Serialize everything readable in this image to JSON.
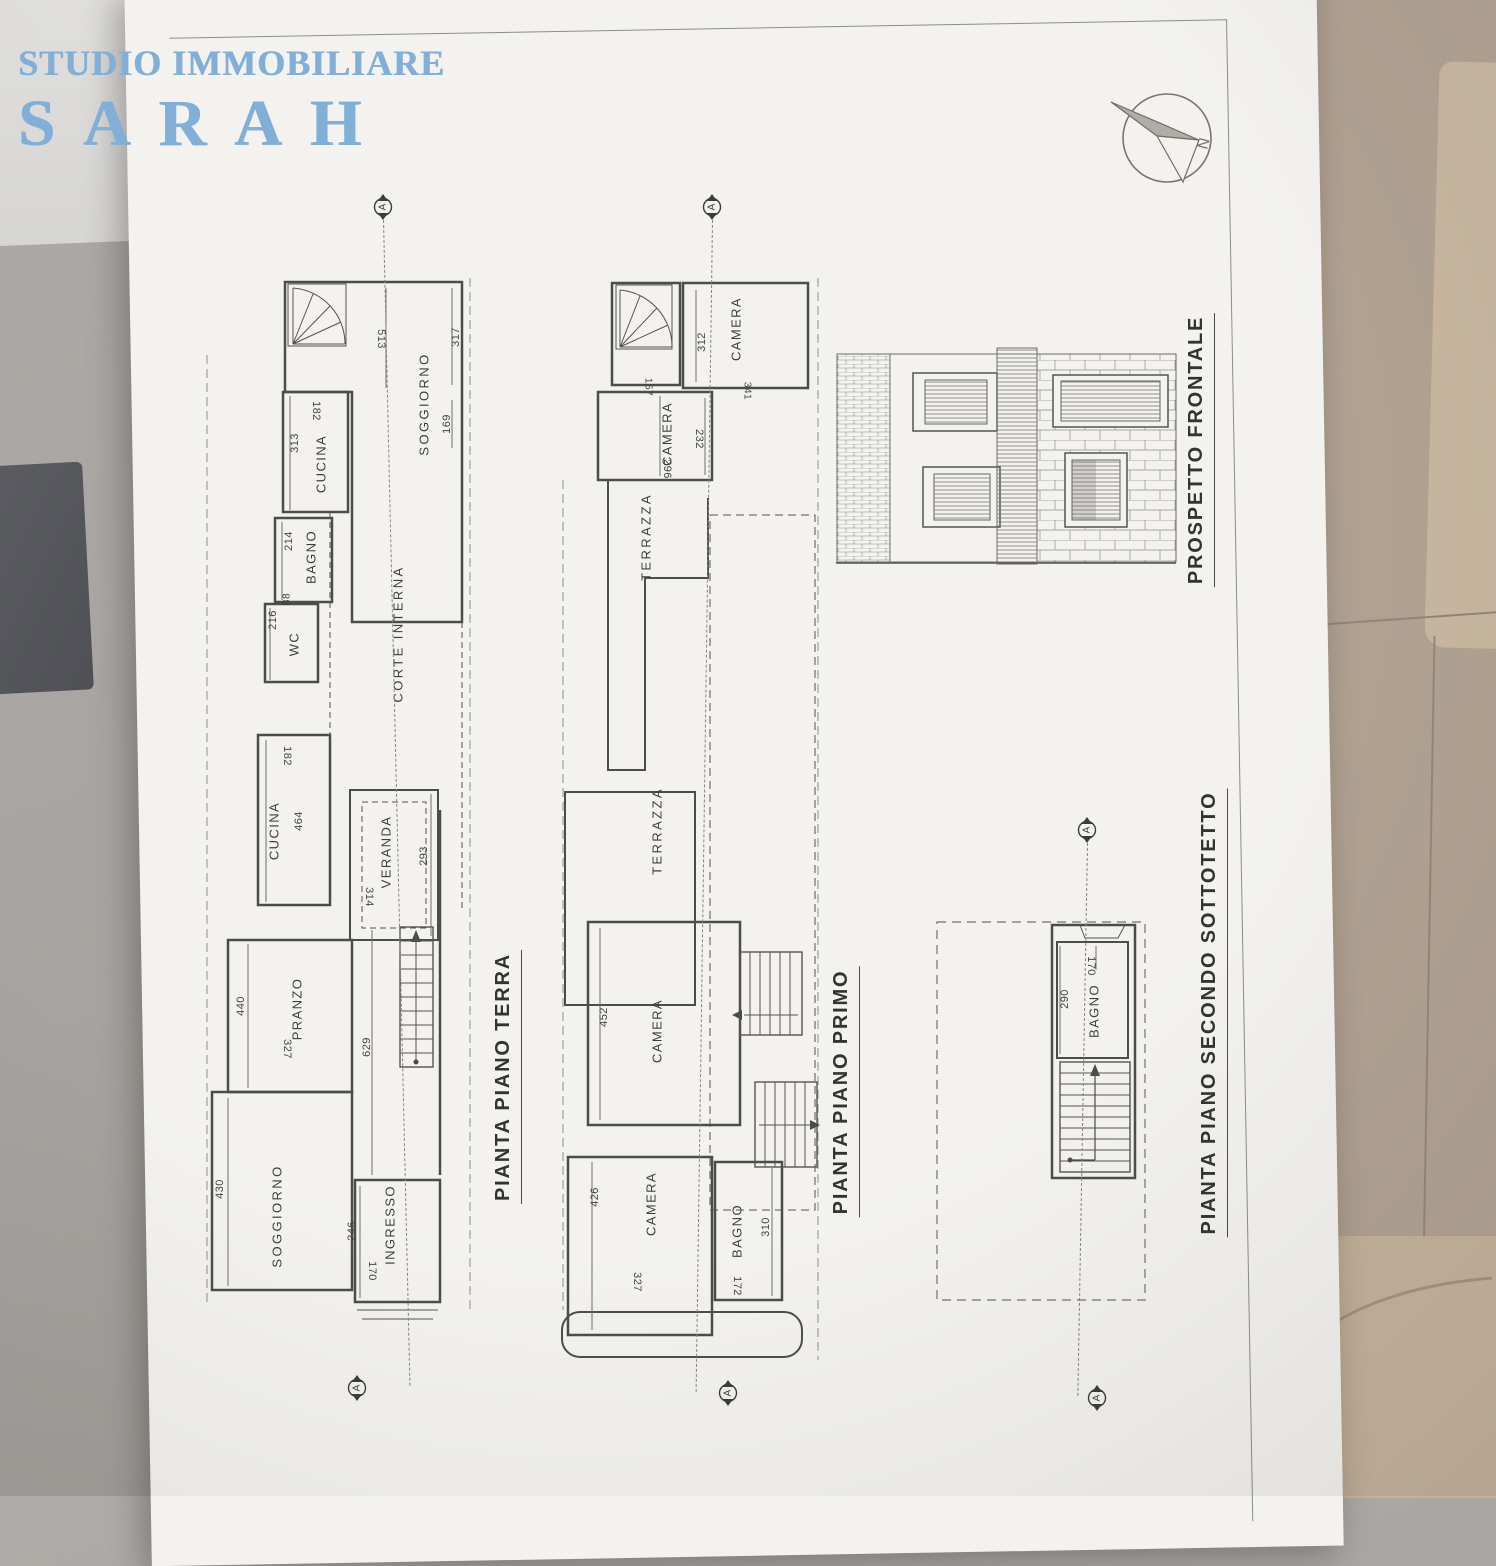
{
  "watermark": {
    "line1": "STUDIO IMMOBILIARE",
    "line2": "SARAH",
    "blue": "#82afd8"
  },
  "compass": {
    "label": "N"
  },
  "section": {
    "label": "A"
  },
  "colors": {
    "paper": "#f3f2ef",
    "ink": "#4c4c48",
    "table": "#a8a4a1",
    "floor": "#b1a292",
    "chair": "#c9b7a0"
  },
  "plans": {
    "terra": {
      "title": "PIANTA PIANO TERRA",
      "rooms": {
        "soggiorno_n": "SOGGIORNO",
        "cucina_n": "CUCINA",
        "bagno": "BAGNO",
        "wc": "WC",
        "corte": "CORTE INTERNA",
        "cucina_s": "CUCINA",
        "veranda": "VERANDA",
        "pranzo": "PRANZO",
        "soggiorno_s": "SOGGIORNO",
        "ingresso": "INGRESSO"
      },
      "dims": {
        "d513": "513",
        "d317": "317",
        "d169": "169",
        "d313": "313",
        "d182a": "182",
        "d214": "214",
        "d216": "216",
        "d88": "88",
        "d464": "464",
        "d182b": "182",
        "d293": "293",
        "d314": "314",
        "d440": "440",
        "d327": "327",
        "d629": "629",
        "d430": "430",
        "d246": "246",
        "d170": "170"
      }
    },
    "primo": {
      "title": "PIANTA PIANO PRIMO",
      "rooms": {
        "camera_a": "CAMERA",
        "camera_b": "CAMERA",
        "terrazza_a": "TERRAZZA",
        "terrazza_b": "TERRAZZA",
        "camera_c": "CAMERA",
        "camera_d": "CAMERA",
        "bagno": "BAGNO"
      },
      "dims": {
        "d312": "312",
        "d157": "157",
        "d341": "341",
        "d232": "232",
        "d296": "296",
        "d452": "452",
        "d426": "426",
        "d327": "327",
        "d310": "310",
        "d172": "172"
      }
    },
    "sottotetto": {
      "title": "PIANTA PIANO SECONDO SOTTOTETTO",
      "rooms": {
        "bagno": "BAGNO"
      },
      "dims": {
        "d290": "290",
        "d170": "170"
      }
    },
    "prospetto": {
      "title": "PROSPETTO FRONTALE"
    }
  }
}
